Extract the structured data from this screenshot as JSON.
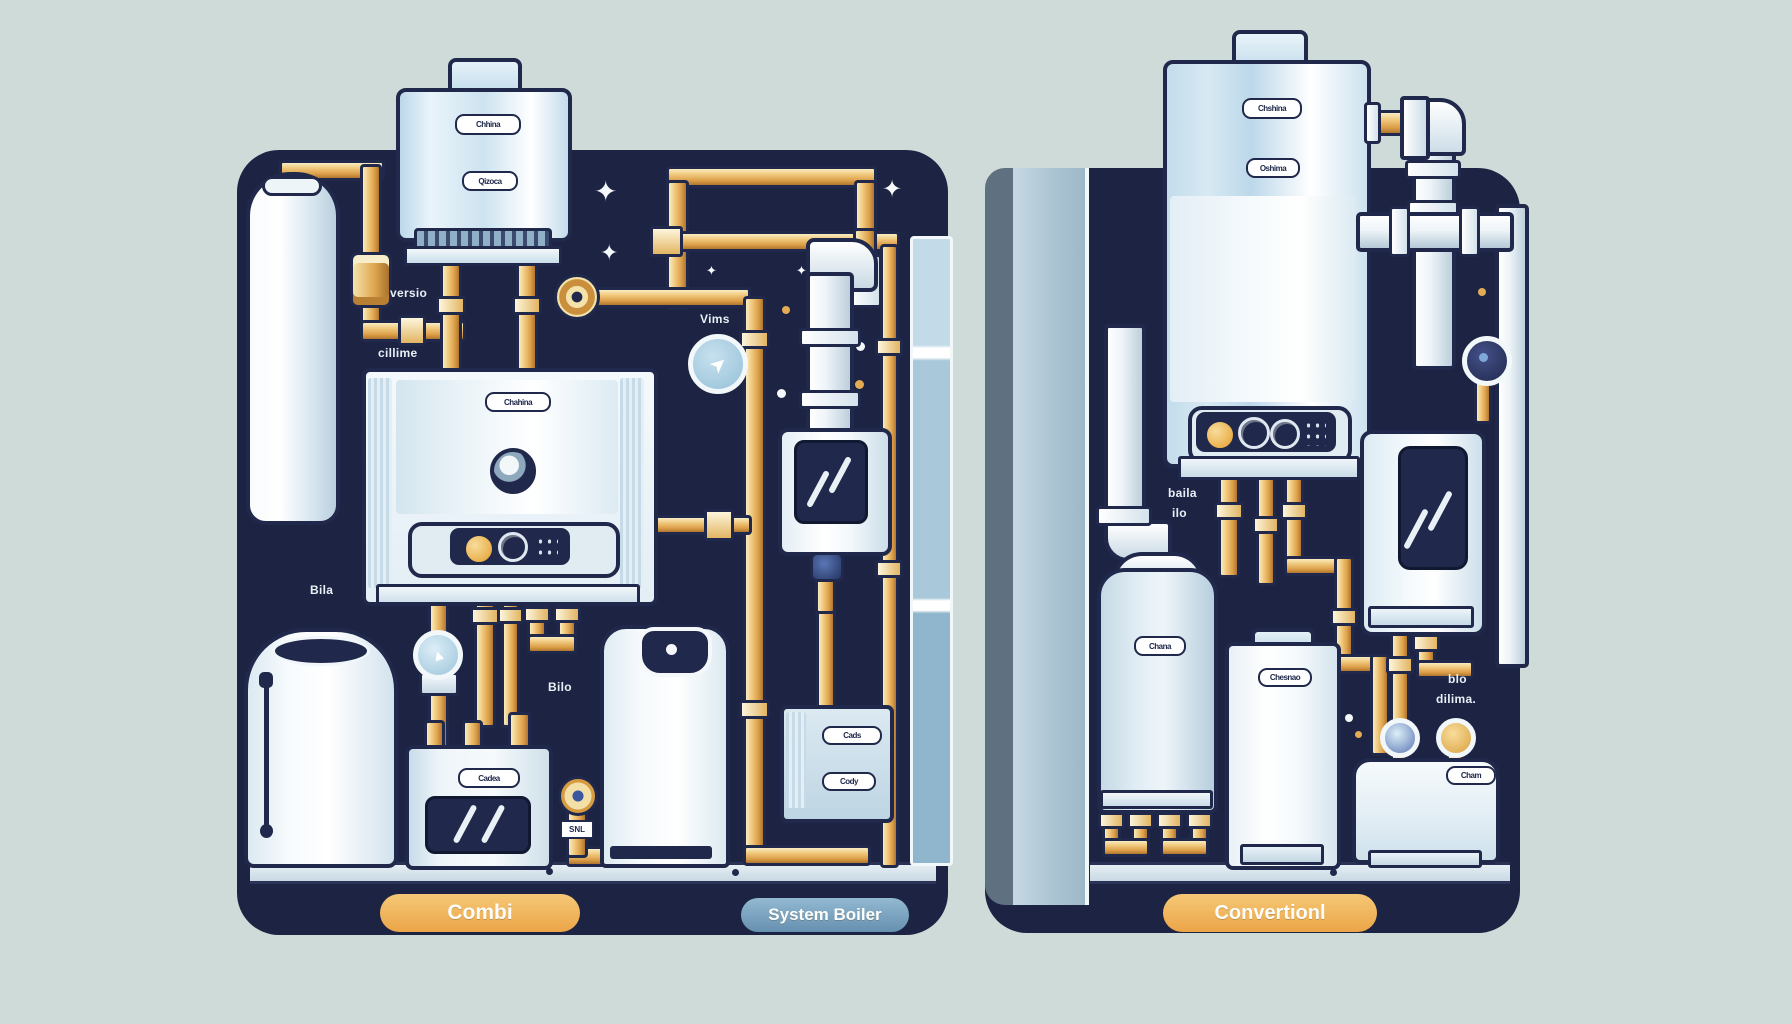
{
  "colors": {
    "pagebg": "#cfdbd8",
    "navy": "#1d2443",
    "gold": "#e2a94f",
    "orange_pill": "#eead4f",
    "blue_pill": "#7ca6c4",
    "equipment_light": "#e8f2f8",
    "wall_gray": "#b0c6d4"
  },
  "pills": {
    "combi": "Combi",
    "system": "System Boiler",
    "conventional": "Convertionl"
  },
  "combi": {
    "labels": {
      "versio": "versio",
      "cillime": "cillime",
      "vims": "Vims",
      "bila": "Bila",
      "bilo": "Bilo",
      "snl": "SNL"
    },
    "badges": {
      "boiler_top": "Chhina",
      "boiler_mid": "Qizoca",
      "mid_boiler": "Chahina",
      "appliance": "Cadea",
      "unit_a": "Cads",
      "unit_b": "Cody"
    }
  },
  "conventional": {
    "labels": {
      "baila": "baila",
      "ilo": "ilo",
      "blo": "blo",
      "dilima": "dilima."
    },
    "badges": {
      "boiler_top": "Chshina",
      "boiler_mid": "Oshima",
      "blue_cylinder": "Chana",
      "white_cylinder": "Chesnao",
      "tank": "Cham"
    }
  },
  "icons": {
    "gauge_arrow": "➤",
    "pump_arrow": "▲",
    "star": "✦"
  }
}
